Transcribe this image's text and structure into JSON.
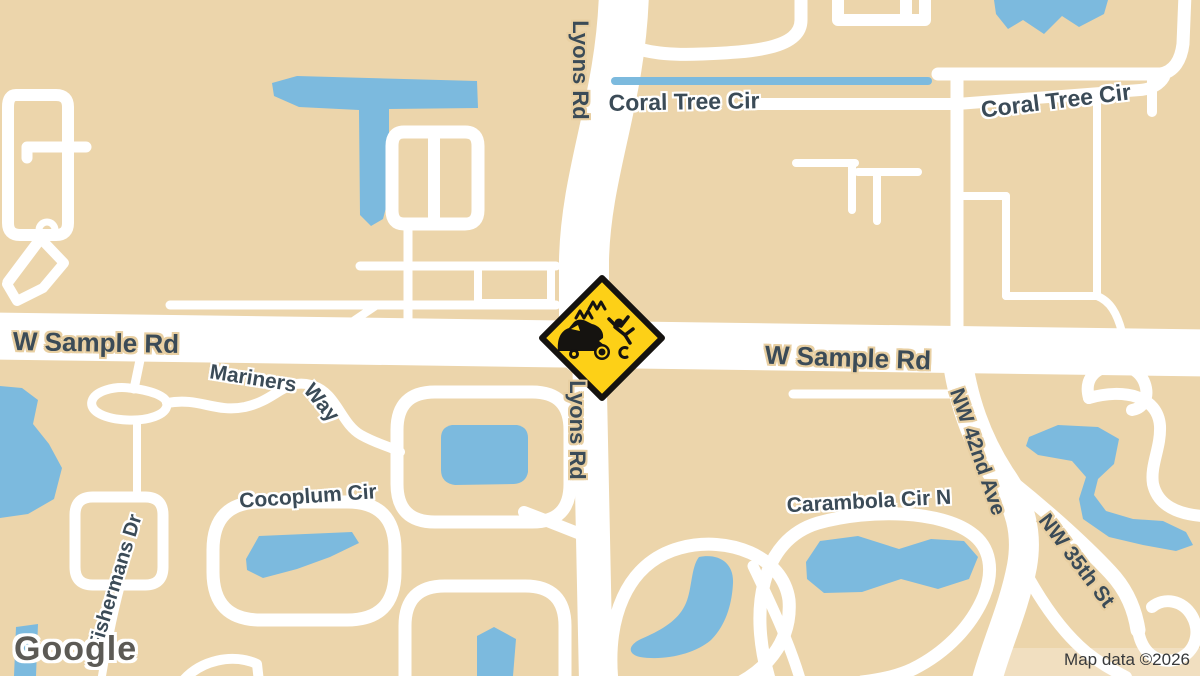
{
  "map": {
    "type": "road-map",
    "labels": {
      "lyons_rd_north": "Lyons Rd",
      "lyons_rd_south": "Lyons Rd",
      "coral_tree_cir_west": "Coral Tree Cir",
      "coral_tree_cir_east": "Coral Tree Cir",
      "w_sample_rd_west": "W Sample Rd",
      "w_sample_rd_east": "W Sample Rd",
      "mariners_way_word1": "Mariners",
      "mariners_way_word2": "Way",
      "cocoplum_cir": "Cocoplum Cir",
      "fishermans_dr": "Fishermans Dr",
      "carambola_cir_n": "Carambola Cir N",
      "nw_42nd_ave": "NW 42nd Ave",
      "nw_35th_st": "NW 35th St"
    },
    "incident": {
      "icon": "vehicle-collision-warning-sign"
    },
    "colors": {
      "land": "#ecd5ab",
      "water": "#7cbade",
      "road": "#ffffff",
      "label_text": "#3b4b57",
      "label_halo_on_land": "#ffffff",
      "label_halo_on_road": "#e8cfa2",
      "sign_yellow": "#fdd017",
      "sign_black": "#151310"
    }
  },
  "watermark": {
    "logo_text": "Google"
  },
  "attribution": {
    "text": "Map data ©2026"
  }
}
